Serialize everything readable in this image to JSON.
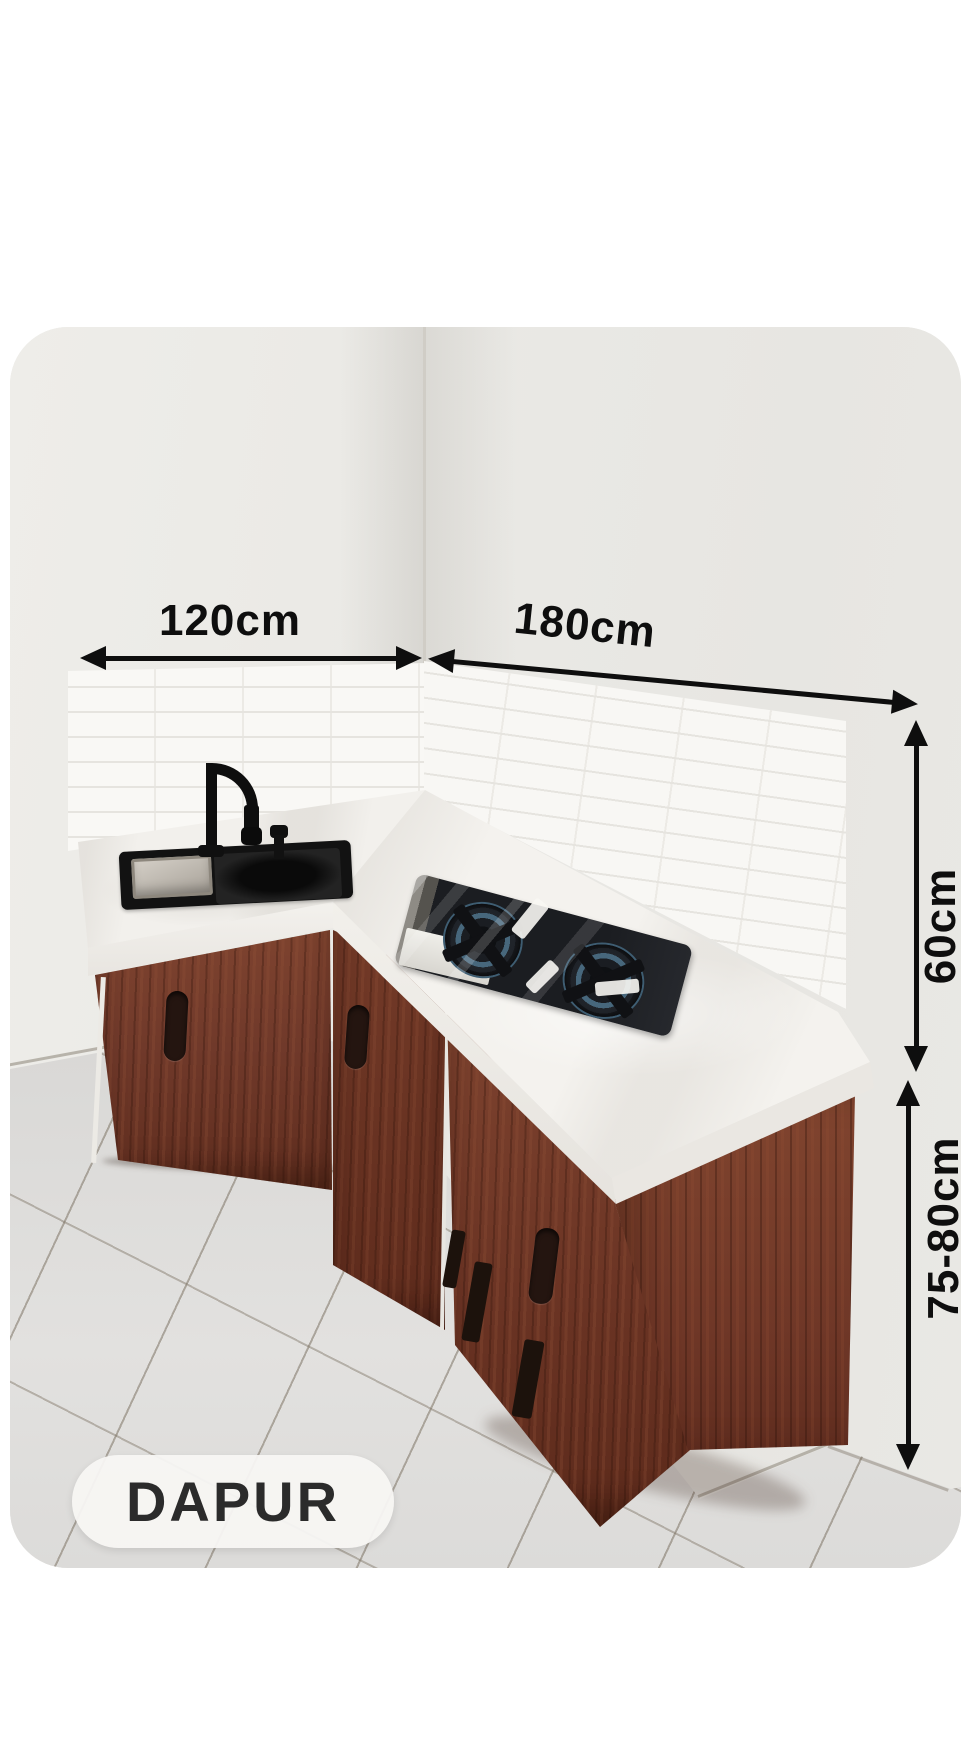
{
  "page": {
    "background": "#ffffff"
  },
  "photo": {
    "subject": "kitchen corner with white subway-tile backsplash, white stone countertop, dark wood cabinets, black sink with gooseneck faucet and two-burner gas hob",
    "colors": {
      "wall": "#eae9e5",
      "tile": "#f9f8f5",
      "countertop": "#f3f1ed",
      "cabinet_wood": "#78402d",
      "floor": "#dddcda",
      "sink": "#121212"
    }
  },
  "dimensions": {
    "ink_color": "#0e0e0e",
    "left_counter_width": "120cm",
    "right_counter_width": "180cm",
    "backsplash_height": "60cm",
    "counter_height": "75-80cm"
  },
  "badge": {
    "label": "DAPUR",
    "background": "#f7f6f3",
    "text_color": "#2b2b2b"
  }
}
